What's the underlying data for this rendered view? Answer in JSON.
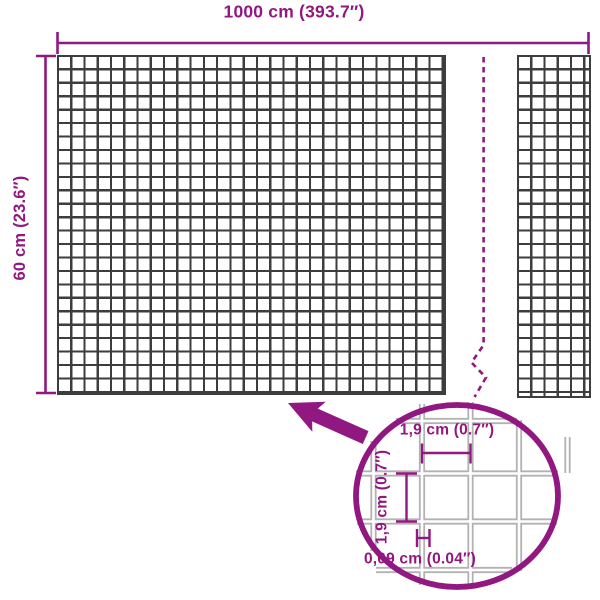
{
  "diagram": {
    "overall_width_label": "1000 cm (393.7″)",
    "overall_height_label": "60 cm (23.6″)",
    "detail": {
      "opening_width_label": "1,9 cm (0.7″)",
      "opening_height_label": "1,9 cm (0.7″)",
      "wire_thickness_label": "0,09 cm (0.04″)"
    },
    "colors": {
      "accent": "#901880",
      "grid_dark": "#3d3d3d",
      "mesh_light": "#b2b2b2",
      "bg": "#ffffff"
    }
  }
}
